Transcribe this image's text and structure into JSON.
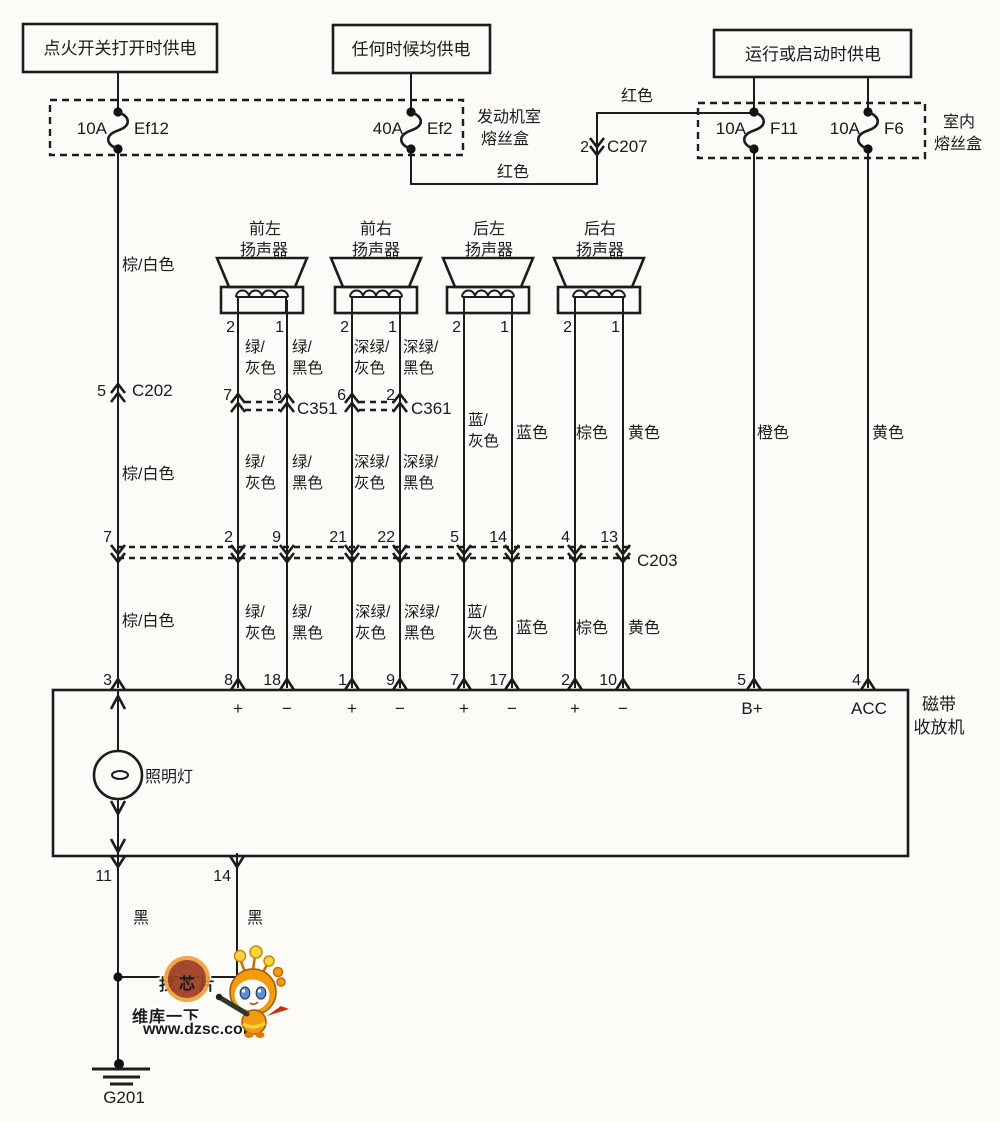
{
  "sources": {
    "ignition": "点火开关打开时供电",
    "always": "任何时候均供电",
    "run_start": "运行或启动时供电"
  },
  "fuse_box_engine": {
    "name_l1": "发动机室",
    "name_l2": "熔丝盒"
  },
  "fuse_box_interior": {
    "name_l1": "室内",
    "name_l2": "熔丝盒"
  },
  "fuses": {
    "ef12": {
      "rating": "10A",
      "name": "Ef12"
    },
    "ef2": {
      "rating": "40A",
      "name": "Ef2"
    },
    "f11": {
      "rating": "10A",
      "name": "F11"
    },
    "f6": {
      "rating": "10A",
      "name": "F6"
    }
  },
  "connectors": {
    "c202": {
      "pin": "5",
      "name": "C202"
    },
    "c207": {
      "pin": "2",
      "name": "C207"
    },
    "c351": {
      "pins": [
        "7",
        "8"
      ],
      "name": "C351"
    },
    "c361": {
      "pins": [
        "6",
        "2"
      ],
      "name": "C361"
    },
    "c203": {
      "pins": [
        "7",
        "2",
        "9",
        "21",
        "22",
        "5",
        "14",
        "4",
        "13"
      ],
      "name": "C203"
    }
  },
  "speakers": [
    {
      "l1": "前左",
      "l2": "扬声器",
      "pins": [
        "2",
        "1"
      ]
    },
    {
      "l1": "前右",
      "l2": "扬声器",
      "pins": [
        "2",
        "1"
      ]
    },
    {
      "l1": "后左",
      "l2": "扬声器",
      "pins": [
        "2",
        "1"
      ]
    },
    {
      "l1": "后右",
      "l2": "扬声器",
      "pins": [
        "2",
        "1"
      ]
    }
  ],
  "colors": {
    "red": "红色",
    "brown_white": "棕/白色",
    "green_gray": [
      "绿/",
      "灰色"
    ],
    "green_black": [
      "绿/",
      "黑色"
    ],
    "dark_green_gray": [
      "深绿/",
      "灰色"
    ],
    "dark_green_black": [
      "深绿/",
      "黑色"
    ],
    "blue_gray": [
      "蓝/",
      "灰色"
    ],
    "blue": "蓝色",
    "brown": "棕色",
    "yellow": "黄色",
    "orange": "橙色",
    "black": "黑"
  },
  "unit": {
    "name_l1": "磁带",
    "name_l2": "收放机",
    "top_pins": [
      "3",
      "8",
      "18",
      "1",
      "9",
      "7",
      "17",
      "2",
      "10",
      "5",
      "4"
    ],
    "signs": [
      "+",
      "−",
      "+",
      "−",
      "+",
      "−",
      "+",
      "−"
    ],
    "b_plus": "B+",
    "acc": "ACC",
    "lamp": "照明灯",
    "bottom_pins": [
      "11",
      "14"
    ]
  },
  "ground": {
    "name": "G201"
  },
  "watermark": {
    "t1": "找芯片",
    "t2": "维库一下",
    "url": "www.dzsc.com"
  }
}
